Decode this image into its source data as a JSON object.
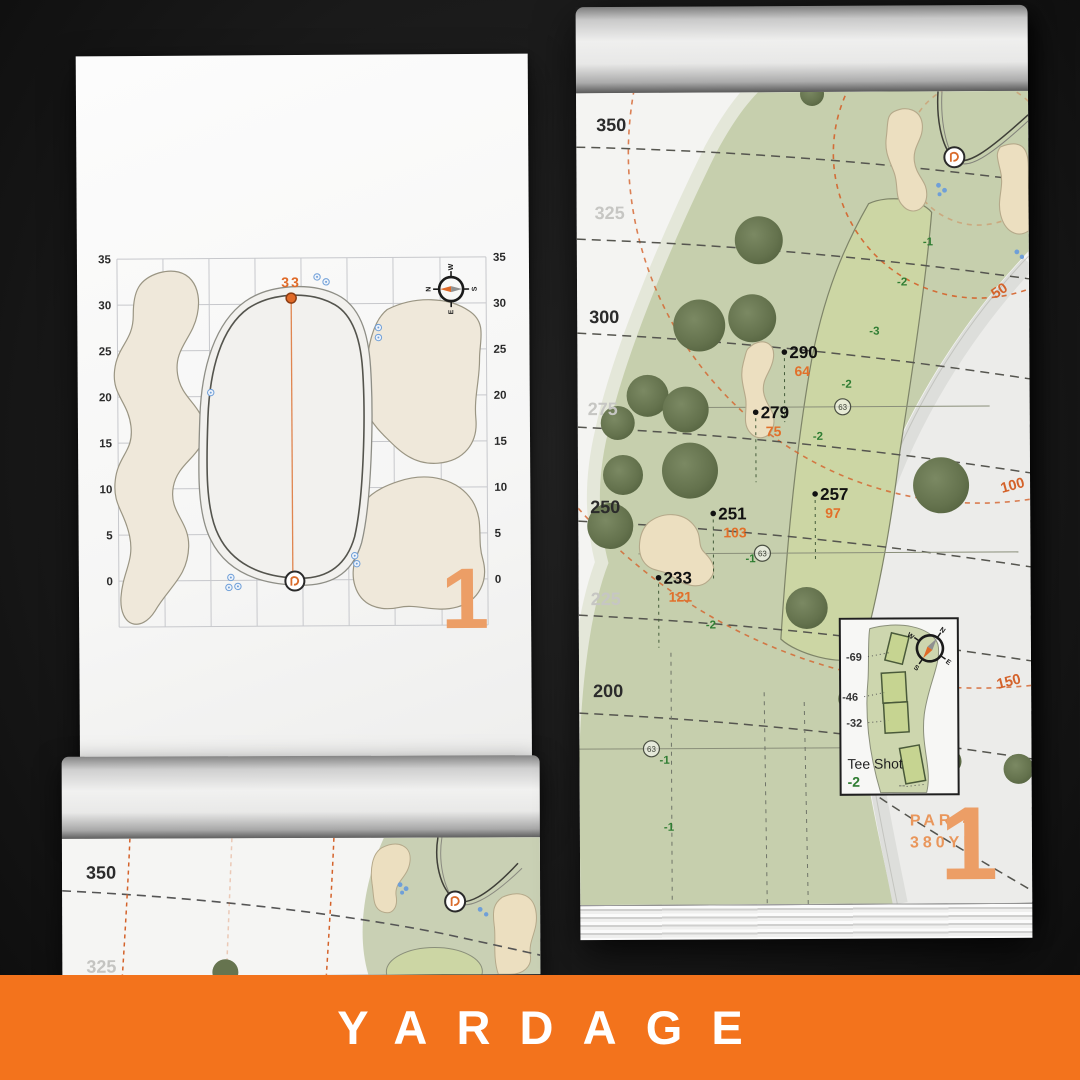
{
  "banner": {
    "label": "YARDAGE",
    "bg_color": "#F3731C"
  },
  "colors": {
    "accent_orange": "#D4622A",
    "peach_numeral": "#EC9E66",
    "slope_green": "#2F7D32",
    "fairway_green": "#C6CFAD"
  },
  "left_page": {
    "pin_distance": "33",
    "hole_number": "1",
    "axis_labels": [
      "35",
      "30",
      "25",
      "20",
      "15",
      "10",
      "5",
      "0"
    ],
    "compass": {
      "n": "N",
      "e": "E",
      "s": "S",
      "w": "W"
    }
  },
  "right_page": {
    "distance_ticks": [
      {
        "label": "350",
        "emphasis": true
      },
      {
        "label": "325",
        "emphasis": false
      },
      {
        "label": "300",
        "emphasis": true
      },
      {
        "label": "275",
        "emphasis": false
      },
      {
        "label": "250",
        "emphasis": true
      },
      {
        "label": "225",
        "emphasis": false
      },
      {
        "label": "200",
        "emphasis": true
      }
    ],
    "arc_labels": [
      "50",
      "100",
      "150"
    ],
    "carry_points": [
      {
        "yards": "290",
        "to_front": "64"
      },
      {
        "yards": "279",
        "to_front": "75"
      },
      {
        "yards": "257",
        "to_front": "97"
      },
      {
        "yards": "251",
        "to_front": "103"
      },
      {
        "yards": "233",
        "to_front": "121"
      }
    ],
    "sprinkler_marks": [
      "63",
      "63",
      "63"
    ],
    "slope_labels": [
      "-1",
      "-2",
      "-3",
      "-2",
      "-2",
      "-1",
      "-2",
      "-1",
      "-1"
    ],
    "tee_inset": {
      "title": "Tee Shot",
      "slope": "-2",
      "carries": [
        "-69",
        "-46",
        "-32"
      ],
      "dots": "--"
    },
    "par_label": "PAR 4",
    "yardage_label": "380YD",
    "hole_number": "1",
    "compass": {
      "n": "N",
      "e": "E",
      "s": "S",
      "w": "W"
    }
  },
  "bottom_page": {
    "distance_ticks": [
      "350",
      "325"
    ]
  }
}
